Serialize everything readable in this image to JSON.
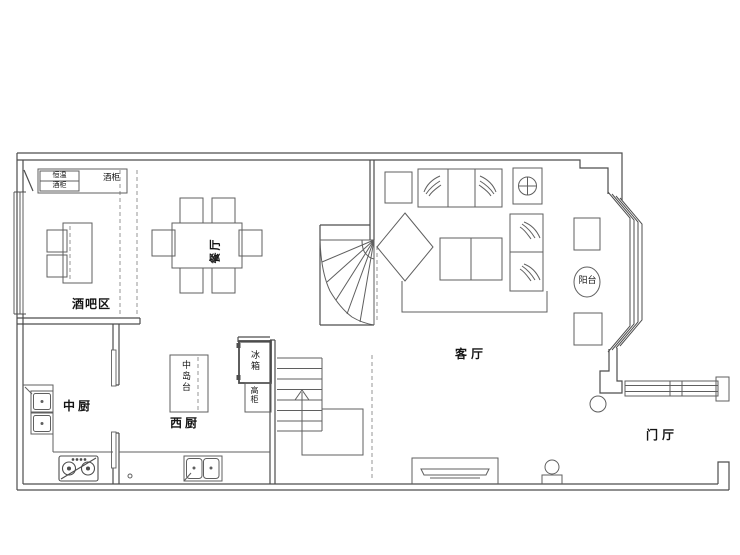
{
  "plan": {
    "rooms": {
      "bar_area": {
        "label": "酒吧区"
      },
      "dining_room": {
        "label": "餐厅"
      },
      "chinese_kitchen": {
        "label": "中厨"
      },
      "western_kitchen": {
        "label": "西厨"
      },
      "living_room": {
        "label": "客厅"
      },
      "balcony": {
        "label": "阳台"
      },
      "foyer": {
        "label": "门厅"
      }
    },
    "fixtures": {
      "wine_fridge_line1": "恒温",
      "wine_fridge_line2": "酒柜",
      "wine_cabinet": "酒柜",
      "kitchen_island": "中岛台",
      "fridge": "冰箱",
      "tall_cabinet": "高柜"
    },
    "colors": {
      "wall_line": "#4d4d4d",
      "furniture_line": "#5f5f5f",
      "background": "#ffffff"
    }
  }
}
